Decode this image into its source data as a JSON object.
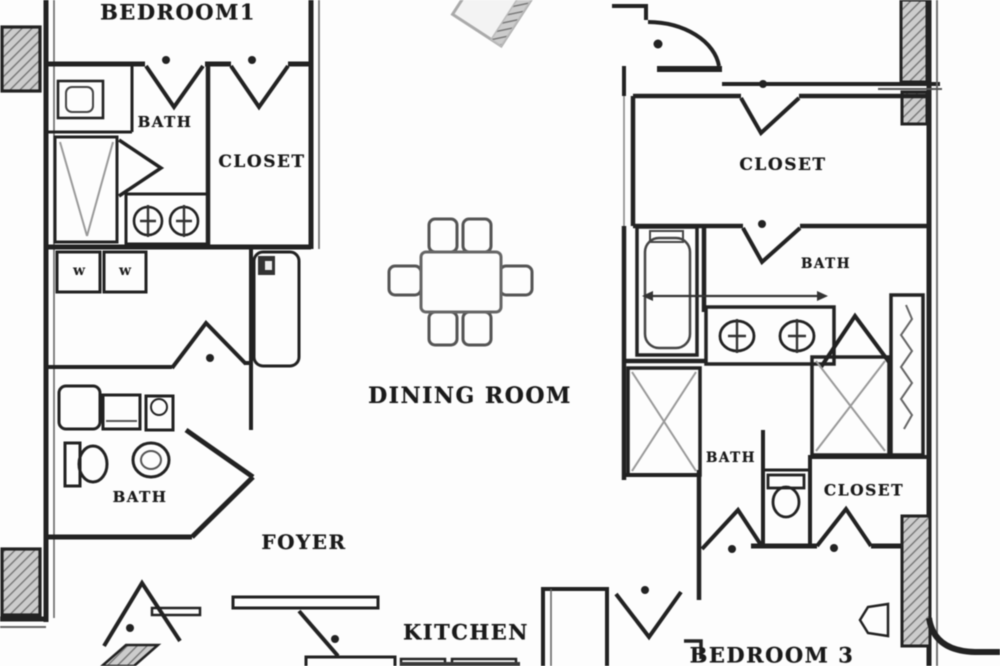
{
  "plan_title": "3-bedroom apartment floor plan",
  "colors": {
    "wall": "#222222",
    "wall_light": "#555555",
    "fixture": "#4a4a4a",
    "fixture_light": "#999999",
    "hatch_fill": "#cccccc",
    "background": "#fdfdfd"
  },
  "labels": {
    "bedroom1": "BEDROOM1",
    "bath_top_left": "BATH",
    "closet_top_left": "CLOSET",
    "dining_room": "DINING ROOM",
    "closet_top_right": "CLOSET",
    "bath_right_upper": "BATH",
    "bath_lower_left": "BATH",
    "foyer": "FOYER",
    "bath_right_lower": "BATH",
    "closet_lower_right": "CLOSET",
    "kitchen": "KITCHEN",
    "bedroom3": "BEDROOM 3"
  },
  "appliances": {
    "washer": "w",
    "dryer": "w"
  }
}
